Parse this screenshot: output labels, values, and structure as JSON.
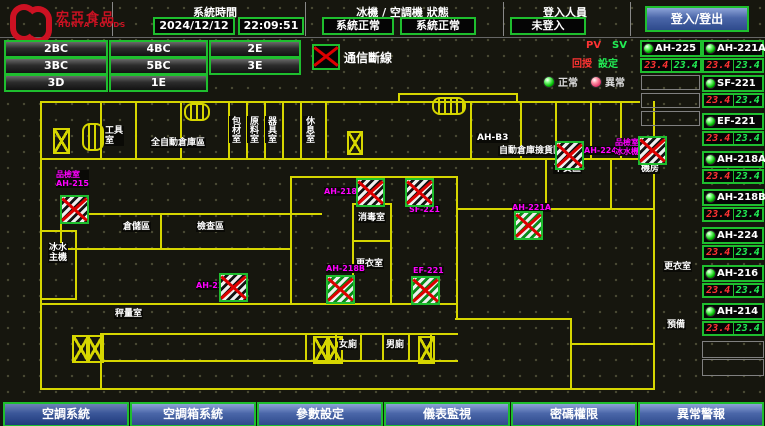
{
  "header": {
    "logo_title": "宏亞食品",
    "logo_subtitle": "HUNYA FOODS",
    "time_label": "系統時間",
    "date_value": "2024/12/12",
    "time_value": "22:09:51",
    "status_label": "冰機 / 空調機 狀態",
    "chiller_status": "系統正常",
    "ahu_status": "系統正常",
    "login_label": "登入人員",
    "login_value": "未登入",
    "login_button": "登入/登出"
  },
  "floor_buttons": [
    {
      "label": "2BC",
      "x": 4,
      "y": 40,
      "w": 100
    },
    {
      "label": "4BC",
      "x": 109,
      "y": 40,
      "w": 95
    },
    {
      "label": "2E",
      "x": 209,
      "y": 40,
      "w": 88
    },
    {
      "label": "3BC",
      "x": 4,
      "y": 57,
      "w": 100
    },
    {
      "label": "5BC",
      "x": 109,
      "y": 57,
      "w": 95
    },
    {
      "label": "3E",
      "x": 209,
      "y": 57,
      "w": 88
    },
    {
      "label": "3D",
      "x": 4,
      "y": 74,
      "w": 100
    },
    {
      "label": "1E",
      "x": 109,
      "y": 74,
      "w": 95
    }
  ],
  "comm": {
    "label": "通信斷線"
  },
  "panel": {
    "pv_header": "PV",
    "sv_header": "SV",
    "pv_row_label": "回授",
    "sv_row_label": "設定",
    "legend_normal": "正常",
    "legend_abnormal": "異常",
    "accent_green": "#1ebe2e",
    "pv_color": "#ff3333",
    "sv_color": "#22ee55",
    "alarm_magenta": "#ff00ff"
  },
  "units": [
    {
      "name": "AH-225",
      "pv": "23.4",
      "sv": "23.4",
      "x": 640,
      "y": 40
    },
    {
      "name": "AH-221A",
      "pv": "23.4",
      "sv": "23.4",
      "x": 702,
      "y": 40
    },
    {
      "name": "SF-221",
      "pv": "23.4",
      "sv": "23.4",
      "x": 702,
      "y": 75
    },
    {
      "name": "EF-221",
      "pv": "23.4",
      "sv": "23.4",
      "x": 702,
      "y": 113
    },
    {
      "name": "AH-218A",
      "pv": "23.4",
      "sv": "23.4",
      "x": 702,
      "y": 151
    },
    {
      "name": "AH-218B",
      "pv": "23.4",
      "sv": "23.4",
      "x": 702,
      "y": 189
    },
    {
      "name": "AH-224",
      "pv": "23.4",
      "sv": "23.4",
      "x": 702,
      "y": 227
    },
    {
      "name": "AH-216",
      "pv": "23.4",
      "sv": "23.4",
      "x": 702,
      "y": 265
    },
    {
      "name": "AH-214",
      "pv": "23.4",
      "sv": "23.4",
      "x": 702,
      "y": 303
    }
  ],
  "empty_boxes": [
    {
      "x": 641,
      "y": 75,
      "w": 57,
      "h": 13
    },
    {
      "x": 641,
      "y": 93,
      "w": 57,
      "h": 13
    },
    {
      "x": 641,
      "y": 111,
      "w": 57,
      "h": 13
    },
    {
      "x": 702,
      "y": 341,
      "w": 60,
      "h": 15
    },
    {
      "x": 702,
      "y": 359,
      "w": 60,
      "h": 15
    }
  ],
  "nav": [
    {
      "label": "空調系統",
      "x": 3,
      "cls": "active"
    },
    {
      "label": "空調箱系統",
      "x": 130
    },
    {
      "label": "參數設定",
      "x": 257
    },
    {
      "label": "儀表監視",
      "x": 384
    },
    {
      "label": "密碼權限",
      "x": 511
    },
    {
      "label": "異常警報",
      "x": 638
    }
  ],
  "map": {
    "walls": [
      {
        "x": 40,
        "y": 101,
        "w": 600,
        "h": 2
      },
      {
        "x": 398,
        "y": 93,
        "w": 120,
        "h": 2
      },
      {
        "x": 398,
        "y": 93,
        "w": 2,
        "h": 10
      },
      {
        "x": 516,
        "y": 93,
        "w": 2,
        "h": 10
      },
      {
        "x": 40,
        "y": 158,
        "w": 600,
        "h": 2
      },
      {
        "x": 40,
        "y": 101,
        "w": 2,
        "h": 289
      },
      {
        "x": 653,
        "y": 101,
        "w": 2,
        "h": 289
      },
      {
        "x": 40,
        "y": 388,
        "w": 615,
        "h": 2
      },
      {
        "x": 100,
        "y": 101,
        "w": 2,
        "h": 59
      },
      {
        "x": 135,
        "y": 101,
        "w": 2,
        "h": 59
      },
      {
        "x": 180,
        "y": 101,
        "w": 2,
        "h": 59
      },
      {
        "x": 228,
        "y": 101,
        "w": 2,
        "h": 59
      },
      {
        "x": 246,
        "y": 101,
        "w": 2,
        "h": 59
      },
      {
        "x": 264,
        "y": 101,
        "w": 2,
        "h": 59
      },
      {
        "x": 282,
        "y": 101,
        "w": 2,
        "h": 59
      },
      {
        "x": 300,
        "y": 101,
        "w": 2,
        "h": 59
      },
      {
        "x": 325,
        "y": 101,
        "w": 2,
        "h": 59
      },
      {
        "x": 470,
        "y": 101,
        "w": 2,
        "h": 59
      },
      {
        "x": 520,
        "y": 101,
        "w": 2,
        "h": 59
      },
      {
        "x": 555,
        "y": 101,
        "w": 2,
        "h": 59
      },
      {
        "x": 590,
        "y": 101,
        "w": 2,
        "h": 59
      },
      {
        "x": 620,
        "y": 101,
        "w": 2,
        "h": 59
      },
      {
        "x": 60,
        "y": 213,
        "w": 262,
        "h": 2
      },
      {
        "x": 60,
        "y": 248,
        "w": 230,
        "h": 2
      },
      {
        "x": 60,
        "y": 213,
        "w": 2,
        "h": 37
      },
      {
        "x": 160,
        "y": 213,
        "w": 2,
        "h": 37
      },
      {
        "x": 290,
        "y": 176,
        "w": 168,
        "h": 2
      },
      {
        "x": 290,
        "y": 176,
        "w": 2,
        "h": 129
      },
      {
        "x": 456,
        "y": 176,
        "w": 2,
        "h": 144
      },
      {
        "x": 290,
        "y": 303,
        "w": 168,
        "h": 2
      },
      {
        "x": 352,
        "y": 203,
        "w": 2,
        "h": 102
      },
      {
        "x": 390,
        "y": 203,
        "w": 2,
        "h": 102
      },
      {
        "x": 352,
        "y": 240,
        "w": 40,
        "h": 2
      },
      {
        "x": 352,
        "y": 203,
        "w": 40,
        "h": 2
      },
      {
        "x": 456,
        "y": 208,
        "w": 199,
        "h": 2
      },
      {
        "x": 545,
        "y": 158,
        "w": 2,
        "h": 52
      },
      {
        "x": 610,
        "y": 158,
        "w": 2,
        "h": 52
      },
      {
        "x": 40,
        "y": 303,
        "w": 250,
        "h": 2
      },
      {
        "x": 100,
        "y": 333,
        "w": 358,
        "h": 2
      },
      {
        "x": 100,
        "y": 360,
        "w": 358,
        "h": 2
      },
      {
        "x": 100,
        "y": 333,
        "w": 2,
        "h": 57
      },
      {
        "x": 455,
        "y": 318,
        "w": 117,
        "h": 2
      },
      {
        "x": 570,
        "y": 318,
        "w": 2,
        "h": 72
      },
      {
        "x": 570,
        "y": 343,
        "w": 85,
        "h": 2
      },
      {
        "x": 305,
        "y": 333,
        "w": 2,
        "h": 29
      },
      {
        "x": 335,
        "y": 333,
        "w": 2,
        "h": 29
      },
      {
        "x": 360,
        "y": 333,
        "w": 2,
        "h": 29
      },
      {
        "x": 382,
        "y": 333,
        "w": 2,
        "h": 29
      },
      {
        "x": 408,
        "y": 333,
        "w": 2,
        "h": 29
      },
      {
        "x": 430,
        "y": 333,
        "w": 2,
        "h": 29
      },
      {
        "x": 75,
        "y": 230,
        "w": 2,
        "h": 70
      },
      {
        "x": 40,
        "y": 230,
        "w": 37,
        "h": 2
      },
      {
        "x": 40,
        "y": 298,
        "w": 37,
        "h": 2
      }
    ],
    "xboxes": [
      {
        "x": 72,
        "y": 335,
        "w": 14,
        "h": 24
      },
      {
        "x": 86,
        "y": 335,
        "w": 14,
        "h": 24
      },
      {
        "x": 313,
        "y": 336,
        "w": 13,
        "h": 24
      },
      {
        "x": 326,
        "y": 336,
        "w": 13,
        "h": 24
      },
      {
        "x": 418,
        "y": 336,
        "w": 13,
        "h": 24
      },
      {
        "x": 53,
        "y": 128,
        "w": 13,
        "h": 22
      },
      {
        "x": 347,
        "y": 131,
        "w": 12,
        "h": 20
      }
    ],
    "lifts": [
      {
        "x": 82,
        "y": 123,
        "w": 18,
        "h": 24
      },
      {
        "x": 184,
        "y": 103,
        "w": 22,
        "h": 14
      },
      {
        "x": 432,
        "y": 97,
        "w": 30,
        "h": 14
      }
    ],
    "white_labels": [
      {
        "text": "工具\n室",
        "x": 104,
        "y": 126
      },
      {
        "text": "全自動倉庫區",
        "x": 150,
        "y": 138
      },
      {
        "text": "包材室",
        "x": 229,
        "y": 116,
        "cls": "vert"
      },
      {
        "text": "原料室",
        "x": 247,
        "y": 116,
        "cls": "vert"
      },
      {
        "text": "器具室",
        "x": 265,
        "y": 116,
        "cls": "vert"
      },
      {
        "text": "休息室",
        "x": 303,
        "y": 116,
        "cls": "vert"
      },
      {
        "text": "AH-B3",
        "x": 476,
        "y": 133
      },
      {
        "text": "自動倉庫撿貨區",
        "x": 498,
        "y": 146
      },
      {
        "text": "下貨區",
        "x": 553,
        "y": 164
      },
      {
        "text": "機房",
        "x": 640,
        "y": 164
      },
      {
        "text": "消毒室",
        "x": 357,
        "y": 213
      },
      {
        "text": "更衣室",
        "x": 355,
        "y": 259
      },
      {
        "text": "檢查區",
        "x": 196,
        "y": 222
      },
      {
        "text": "倉儲區",
        "x": 122,
        "y": 222
      },
      {
        "text": "冰水\n主機",
        "x": 48,
        "y": 243
      },
      {
        "text": "秤量室",
        "x": 114,
        "y": 309
      },
      {
        "text": "女廁",
        "x": 338,
        "y": 340
      },
      {
        "text": "男廁",
        "x": 385,
        "y": 340
      },
      {
        "text": "更衣室",
        "x": 663,
        "y": 262
      },
      {
        "text": "預備",
        "x": 666,
        "y": 320
      }
    ],
    "magenta_labels": [
      {
        "text": "品檢室\nAH-215",
        "x": 56,
        "y": 170
      },
      {
        "text": "AH-218A",
        "x": 324,
        "y": 187
      },
      {
        "text": "SF-221",
        "x": 409,
        "y": 205
      },
      {
        "text": "AH-218B",
        "x": 326,
        "y": 264
      },
      {
        "text": "EF-221",
        "x": 413,
        "y": 266
      },
      {
        "text": "AH-221A",
        "x": 512,
        "y": 203
      },
      {
        "text": "AH-224",
        "x": 584,
        "y": 146
      },
      {
        "text": "品檢室\n冰水機",
        "x": 615,
        "y": 138
      },
      {
        "text": "AH-214",
        "x": 196,
        "y": 281
      }
    ],
    "icons": [
      {
        "x": 60,
        "y": 195,
        "cls": "bw"
      },
      {
        "x": 356,
        "y": 178,
        "cls": "bw"
      },
      {
        "x": 405,
        "y": 178,
        "cls": "bw"
      },
      {
        "x": 326,
        "y": 275,
        "cls": "gn"
      },
      {
        "x": 411,
        "y": 276,
        "cls": "gn"
      },
      {
        "x": 514,
        "y": 211,
        "cls": "gn"
      },
      {
        "x": 555,
        "y": 141,
        "cls": "bw"
      },
      {
        "x": 638,
        "y": 136,
        "cls": "bw"
      },
      {
        "x": 219,
        "y": 273,
        "cls": "bw"
      }
    ]
  }
}
